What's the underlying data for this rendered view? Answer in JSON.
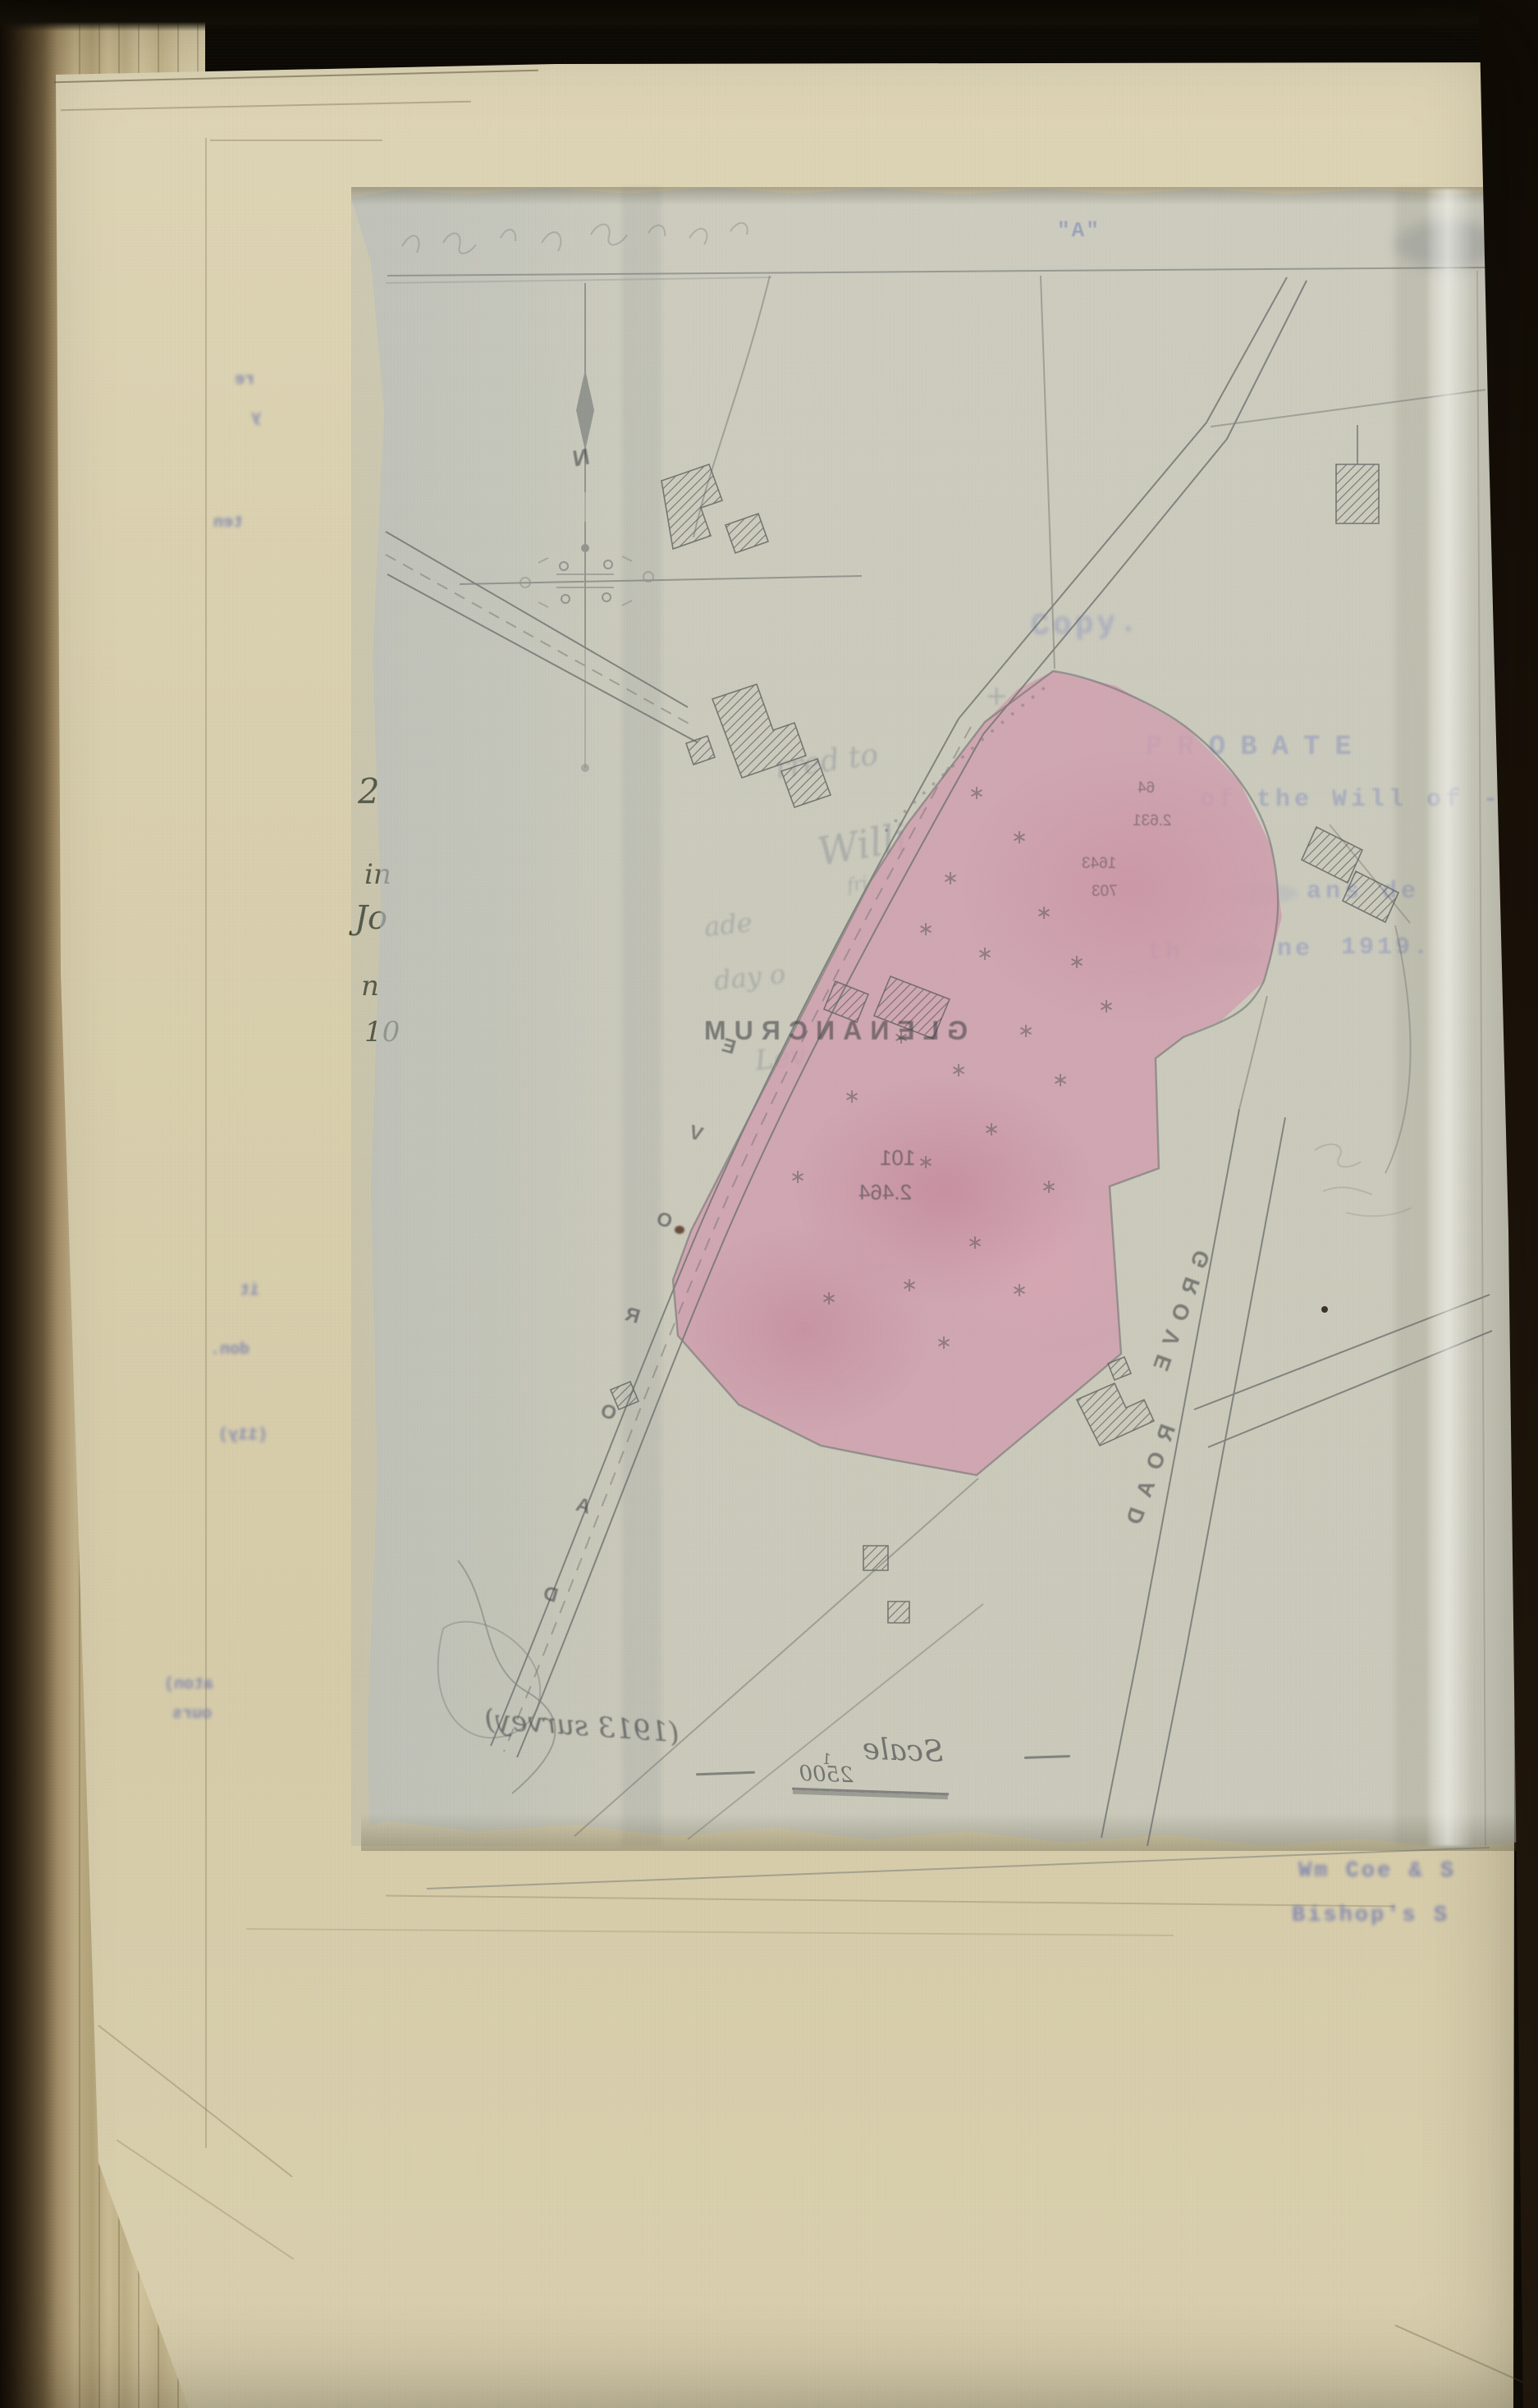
{
  "document": {
    "exhibit_label": "\"A\"",
    "copy_stamp": "Copy.",
    "probate_ghost": {
      "line1": "PROBATE",
      "line2": "of the Will of -",
      "line3": "ans de",
      "line4a": "th",
      "line4b": "ne",
      "line4c": "1919."
    },
    "firm_ghost": {
      "line1": "Wm Coe & S",
      "line2": "Bishop's S"
    },
    "margin_handwriting": [
      "2",
      "in",
      "Jo",
      "n",
      "10"
    ],
    "left_page_fragments": [
      "re",
      "y",
      "ten",
      "it",
      "don.",
      "(11y)",
      "aton)",
      "ours"
    ],
    "pencil_ghost_words": [
      "rred to",
      "Willi",
      "fri",
      "ade",
      "day o",
      "Lev",
      "+"
    ]
  },
  "map": {
    "plot_name": "GLENANCRUM",
    "parcel_number": "101",
    "parcel_area": "2.464",
    "small_numbers": [
      "64",
      "2.631",
      "1643",
      "703"
    ],
    "compass_letter": "N",
    "grove_road": {
      "word1": "GROVE",
      "word2": "ROAD"
    },
    "left_road_letters": [
      "E",
      "V",
      "O",
      "R",
      "O",
      "A",
      "D"
    ],
    "scale": {
      "annotation": "(1913 survey)",
      "label": "Scale",
      "fraction_numerator": "1",
      "fraction_denominator": "2500"
    },
    "tree_glyph": "∗"
  },
  "colors": {
    "page_cream": "#d8cfae",
    "tracing_grey": "#c6c9c3",
    "plot_pink": "#cf9fae",
    "pencil": "#6f7270",
    "blue_type": "#7077ae",
    "margin_ink": "#42462f"
  }
}
